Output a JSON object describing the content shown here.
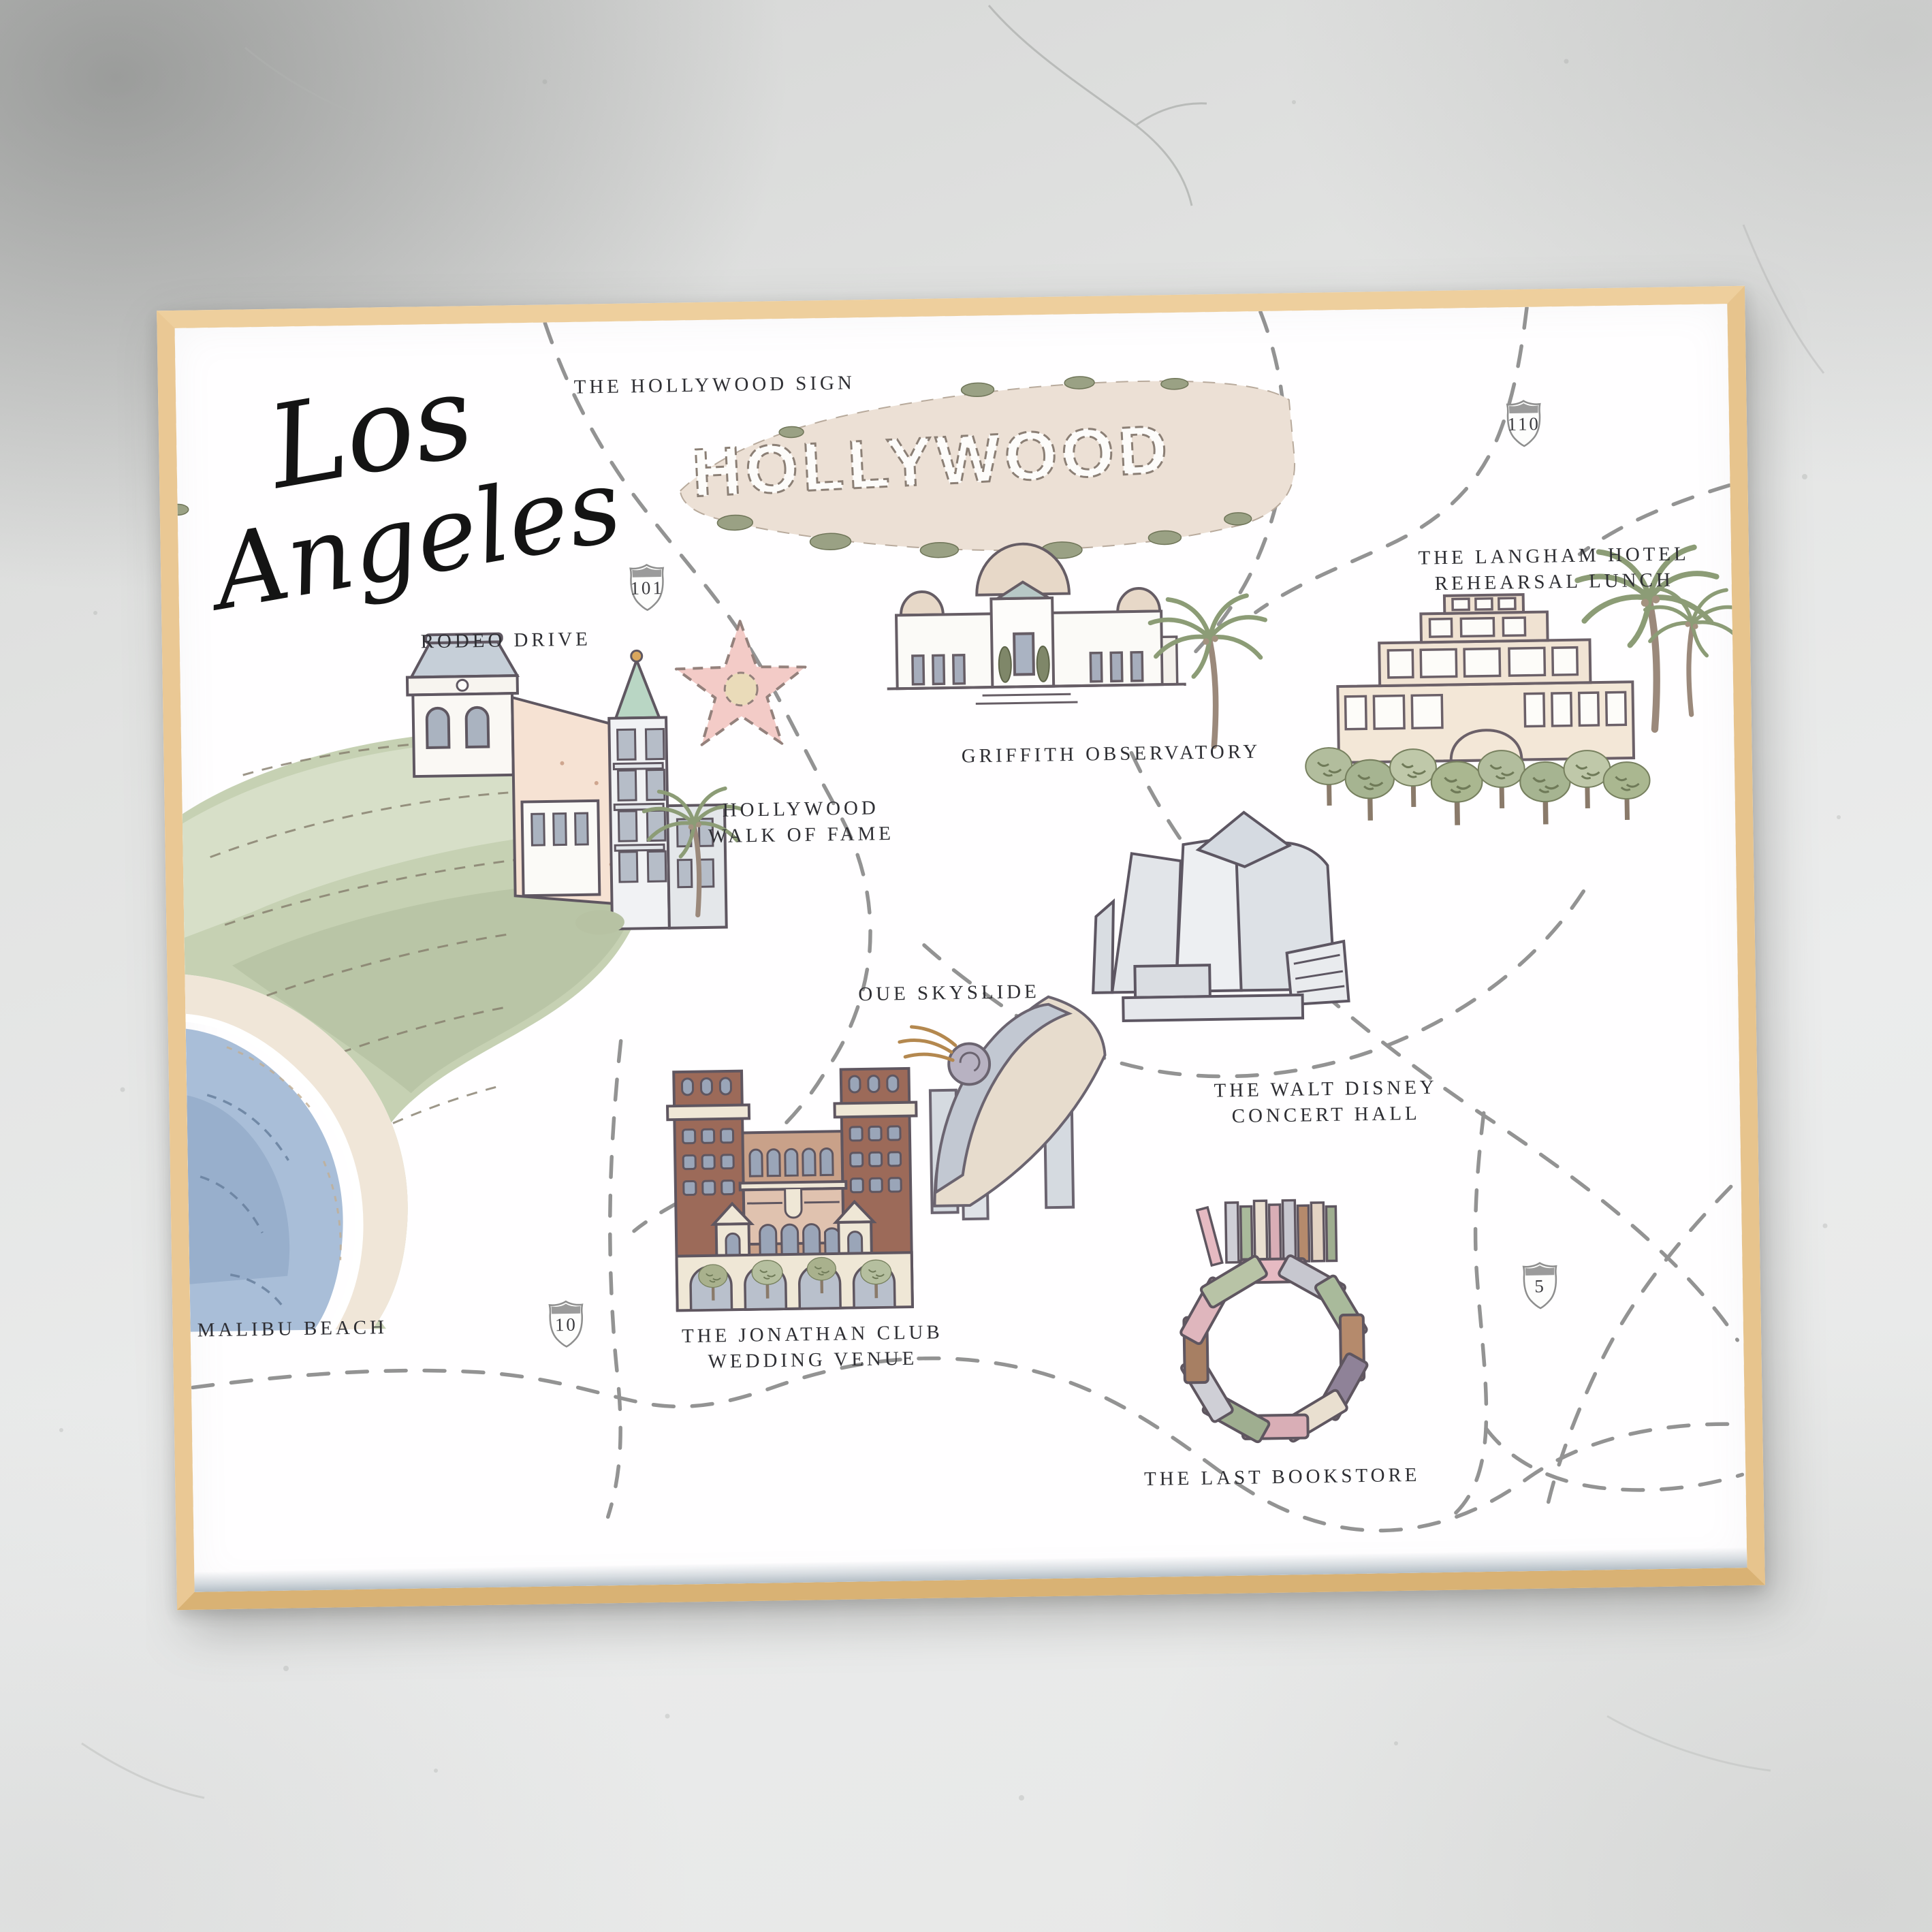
{
  "artwork": {
    "title_line1": "Los",
    "title_line2": "Angeles",
    "sign_text": "HOLLYWOOD",
    "labels": {
      "hollywood_sign": "THE HOLLYWOOD SIGN",
      "rodeo_drive": "RODEO DRIVE",
      "walk_of_fame_line1": "HOLLYWOOD",
      "walk_of_fame_line2": "WALK OF FAME",
      "griffith": "GRIFFITH OBSERVATORY",
      "langham_line1": "THE LANGHAM HOTEL",
      "langham_line2": "REHEARSAL LUNCH",
      "oue": "OUE SKYSLIDE",
      "disney_line1": "THE WALT DISNEY",
      "disney_line2": "CONCERT HALL",
      "malibu": "MALIBU BEACH",
      "jonathan_line1": "THE JONATHAN CLUB",
      "jonathan_line2": "WEDDING VENUE",
      "bookstore": "THE LAST BOOKSTORE"
    },
    "highways": {
      "route_101": "101",
      "route_110": "110",
      "route_10": "10",
      "route_5": "5"
    },
    "colors": {
      "frame_wood": "#e7c48d",
      "paper": "#fffeff",
      "wall": "#e2e3e2",
      "road_dash": "#8a8a8a",
      "label_ink": "#2e2e33",
      "star_pink": "#f3cbc7",
      "sign_hill_beige": "#ece0d5",
      "dome_beige": "#e7d8c8",
      "brick_red": "#9c6a59",
      "mint_turret": "#b9d6c4",
      "sage_green": "#b2bd9d",
      "ocean_blue": "#a9bed8"
    }
  }
}
